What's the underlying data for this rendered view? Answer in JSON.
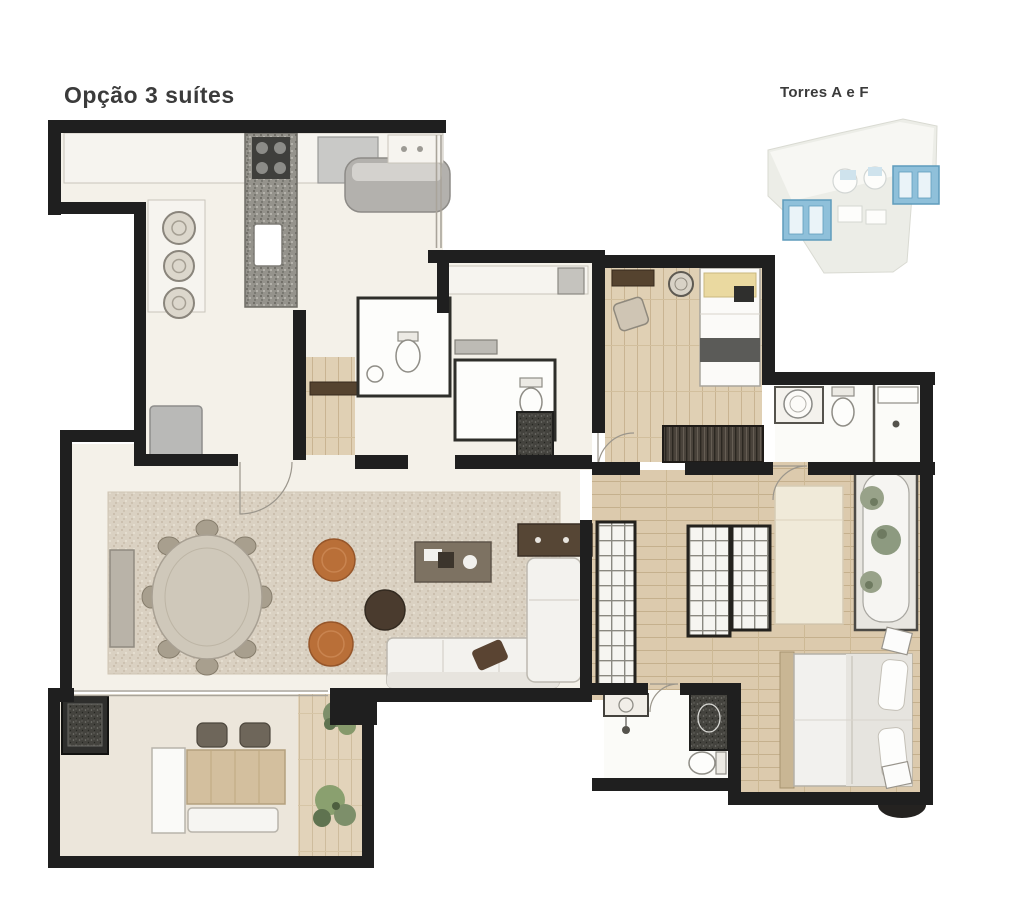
{
  "title": "Opção 3 suítes",
  "site_map": {
    "label": "Torres A e F"
  },
  "colors": {
    "wall": "#1f1f1f",
    "floor-cream": "#f4f1e9",
    "floor-wood": "#dccaad",
    "rug": "#dad1c2",
    "granite": "#95938c",
    "orange": "#b96f38",
    "dark-wood": "#55432f",
    "tower-blue": "#8fc0da",
    "map-ground": "#ecede7",
    "plant-green": "#86996b",
    "text": "#3b3b3b"
  }
}
